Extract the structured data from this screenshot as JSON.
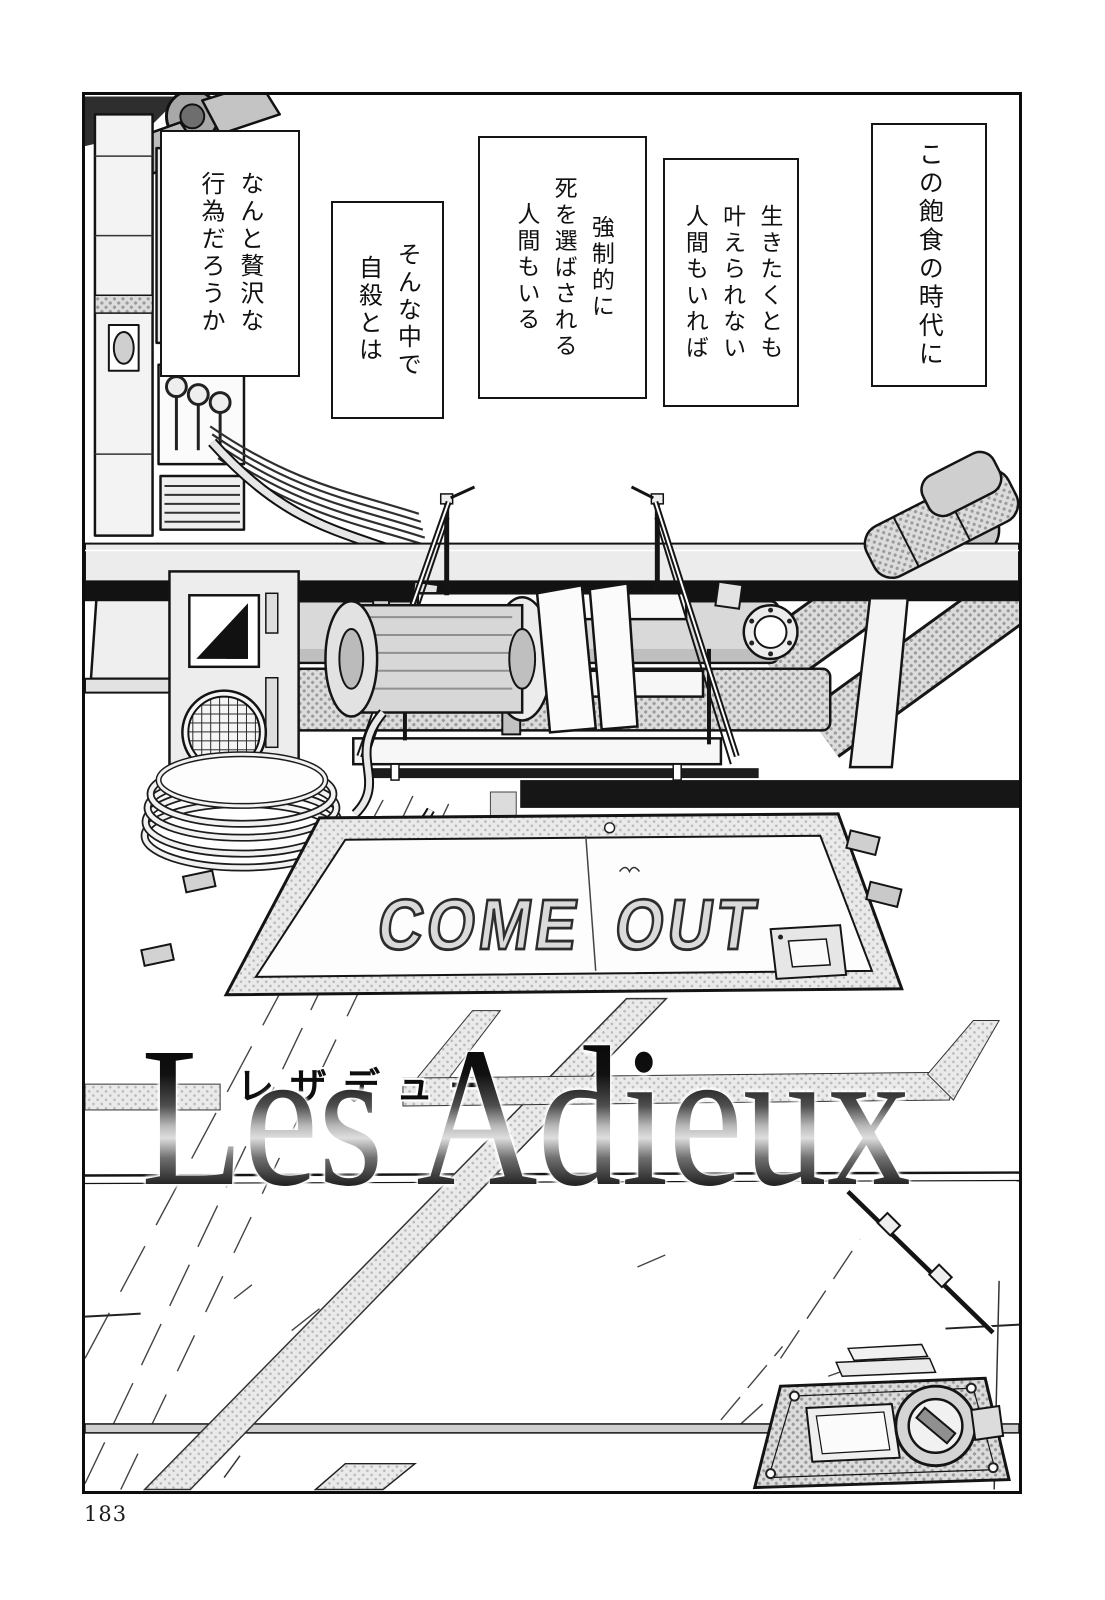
{
  "page": {
    "number": "183"
  },
  "panel": {
    "captions": [
      {
        "text": "この飽食の時代に"
      },
      {
        "text": "生きたくとも\n叶えられない\n人間もいれば"
      },
      {
        "text": "強制的に\n死を選ばされる\n人間もいる"
      },
      {
        "text": "そんな中で\n自殺とは"
      },
      {
        "text": "なんと贅沢な\n行為だろうか"
      }
    ],
    "hatch_sign": "COME OUT",
    "title": {
      "furigana": "レザデュー",
      "text": "Les Adieux"
    }
  },
  "colors": {
    "ink": "#141414",
    "paper": "#ffffff",
    "tone": "#b7b7b7"
  }
}
